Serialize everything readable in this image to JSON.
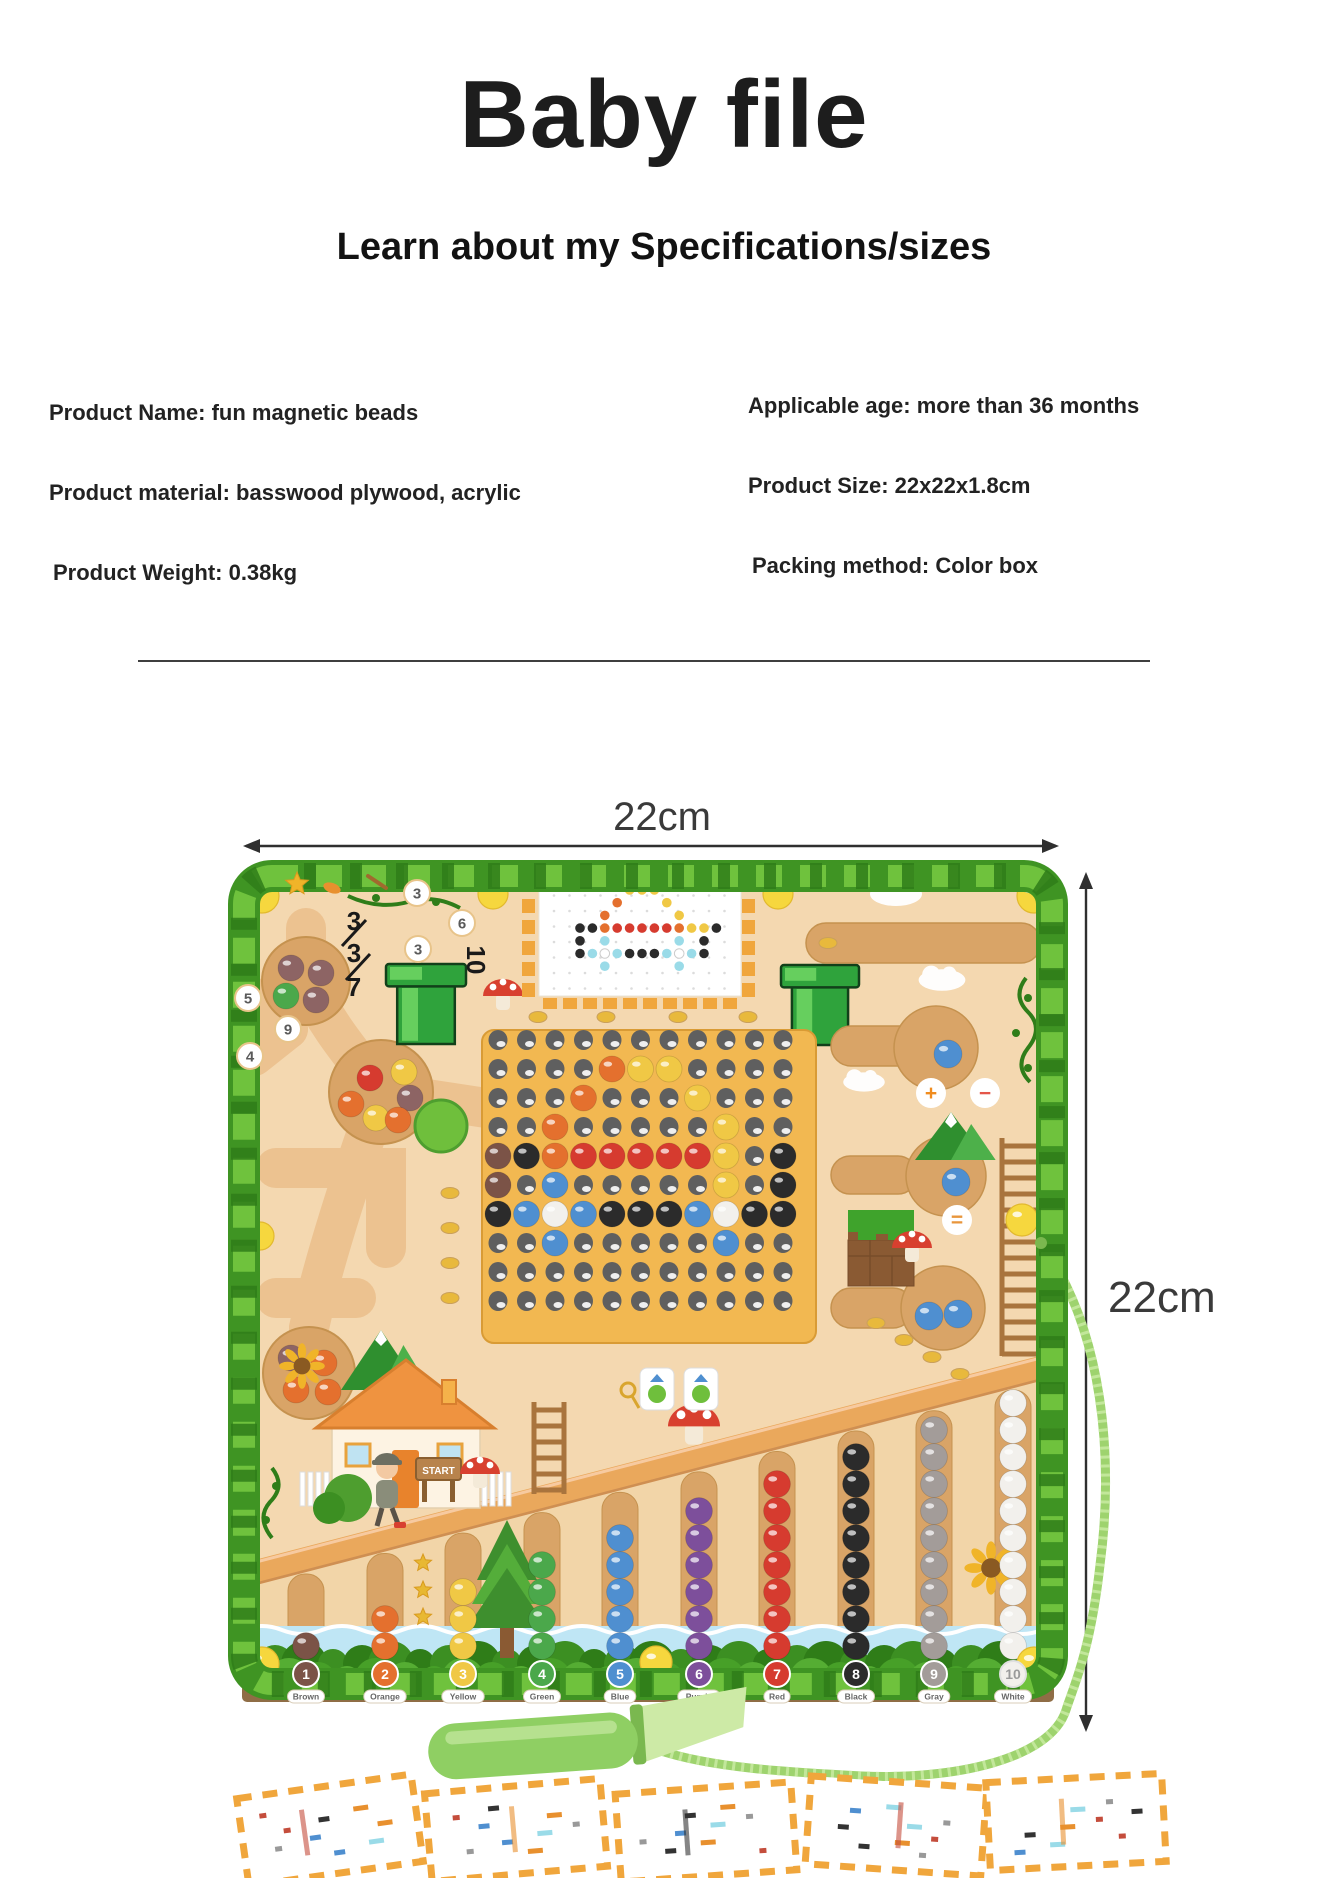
{
  "header": {
    "title": "Baby file",
    "subtitle": "Learn about my Specifications/sizes"
  },
  "specs": {
    "left": [
      "Product Name: fun magnetic beads",
      "Product material: basswood plywood, acrylic",
      "Product Weight: 0.38kg"
    ],
    "right": [
      "Applicable age: more than 36 months",
      "Product Size: 22x22x1.8cm",
      "Packing method: Color box"
    ]
  },
  "dimensions": {
    "width_label": "22cm",
    "height_label": "22cm"
  },
  "board": {
    "start_sign": "START",
    "maze_circle_numbers": [
      "3",
      "6",
      "3",
      "5",
      "9",
      "4"
    ],
    "maze_black_numbers": [
      "3",
      "3",
      "7",
      "10"
    ],
    "operators": [
      "+",
      "−",
      "="
    ],
    "bead_colors": {
      "n": "#7b5347",
      "m": "#8d6464",
      "o": "#e4702e",
      "y": "#f0c845",
      "g": "#4ba84b",
      "b": "#4f8fd0",
      "p": "#7d4f9b",
      "r": "#d63b2f",
      "k": "#2b2b2b",
      "a": "#a39c99",
      "w": "#f2f0ec",
      "c": "#9adbe8"
    },
    "pegboard_rows": [
      "...........",
      "....oyy....",
      "...o...y...",
      "..o.....y..",
      "nkorrrrry.k",
      "n.b.....y.k",
      "kbwbkkkbwkk",
      "..b.....b..",
      "...........",
      "..........."
    ],
    "pattern_card_rows": [
      "....yyy.....",
      "...o...y....",
      "..o.....y...",
      "kkorrrrroyyk",
      "k.c.....c.k.",
      "kcwckkkcwck.",
      "..c.....c..."
    ],
    "pockets": [
      {
        "beads": "mmgm"
      },
      {
        "beads": "yroymo"
      },
      {
        "beads": "mooo"
      }
    ],
    "channels": [
      {
        "number": "1",
        "label": "Brown",
        "color": "#7b5347",
        "count": 1
      },
      {
        "number": "2",
        "label": "Orange",
        "color": "#e4702e",
        "count": 2
      },
      {
        "number": "3",
        "label": "Yellow",
        "color": "#f0c845",
        "count": 3
      },
      {
        "number": "4",
        "label": "Green",
        "color": "#4ba84b",
        "count": 4
      },
      {
        "number": "5",
        "label": "Blue",
        "color": "#4f8fd0",
        "count": 5
      },
      {
        "number": "6",
        "label": "Purple",
        "color": "#7d4f9b",
        "count": 6
      },
      {
        "number": "7",
        "label": "Red",
        "color": "#d63b2f",
        "count": 7
      },
      {
        "number": "8",
        "label": "Black",
        "color": "#2b2b2b",
        "count": 8
      },
      {
        "number": "9",
        "label": "Gray",
        "color": "#a39c99",
        "count": 9
      },
      {
        "number": "10",
        "label": "White",
        "color": "#f2f0ec",
        "count": 10
      }
    ]
  },
  "accessories": {
    "pen_color": "#8fcf63",
    "cord_color": "#9ed36e",
    "cards_count": 5
  },
  "colors": {
    "page_bg": "#ffffff",
    "text": "#1d1d1d",
    "divider": "#3f3f3f",
    "arrow": "#2f2f2f",
    "board_wood": "#f4d8b0",
    "pocket_wood": "#d9a467",
    "groove_wood": "#d9a467",
    "beam_wood": "#eaa85c",
    "pegboard": "#f2b851",
    "leaf": "#49a32b",
    "leaf_dark": "#2f7d19",
    "leaf_light": "#6fc23d",
    "river": "#bfe6f5",
    "edge": "#8f6d46",
    "dash": "#f0a63c",
    "ladder": "#a9743d",
    "ball_yellow": "#f6d73e"
  }
}
